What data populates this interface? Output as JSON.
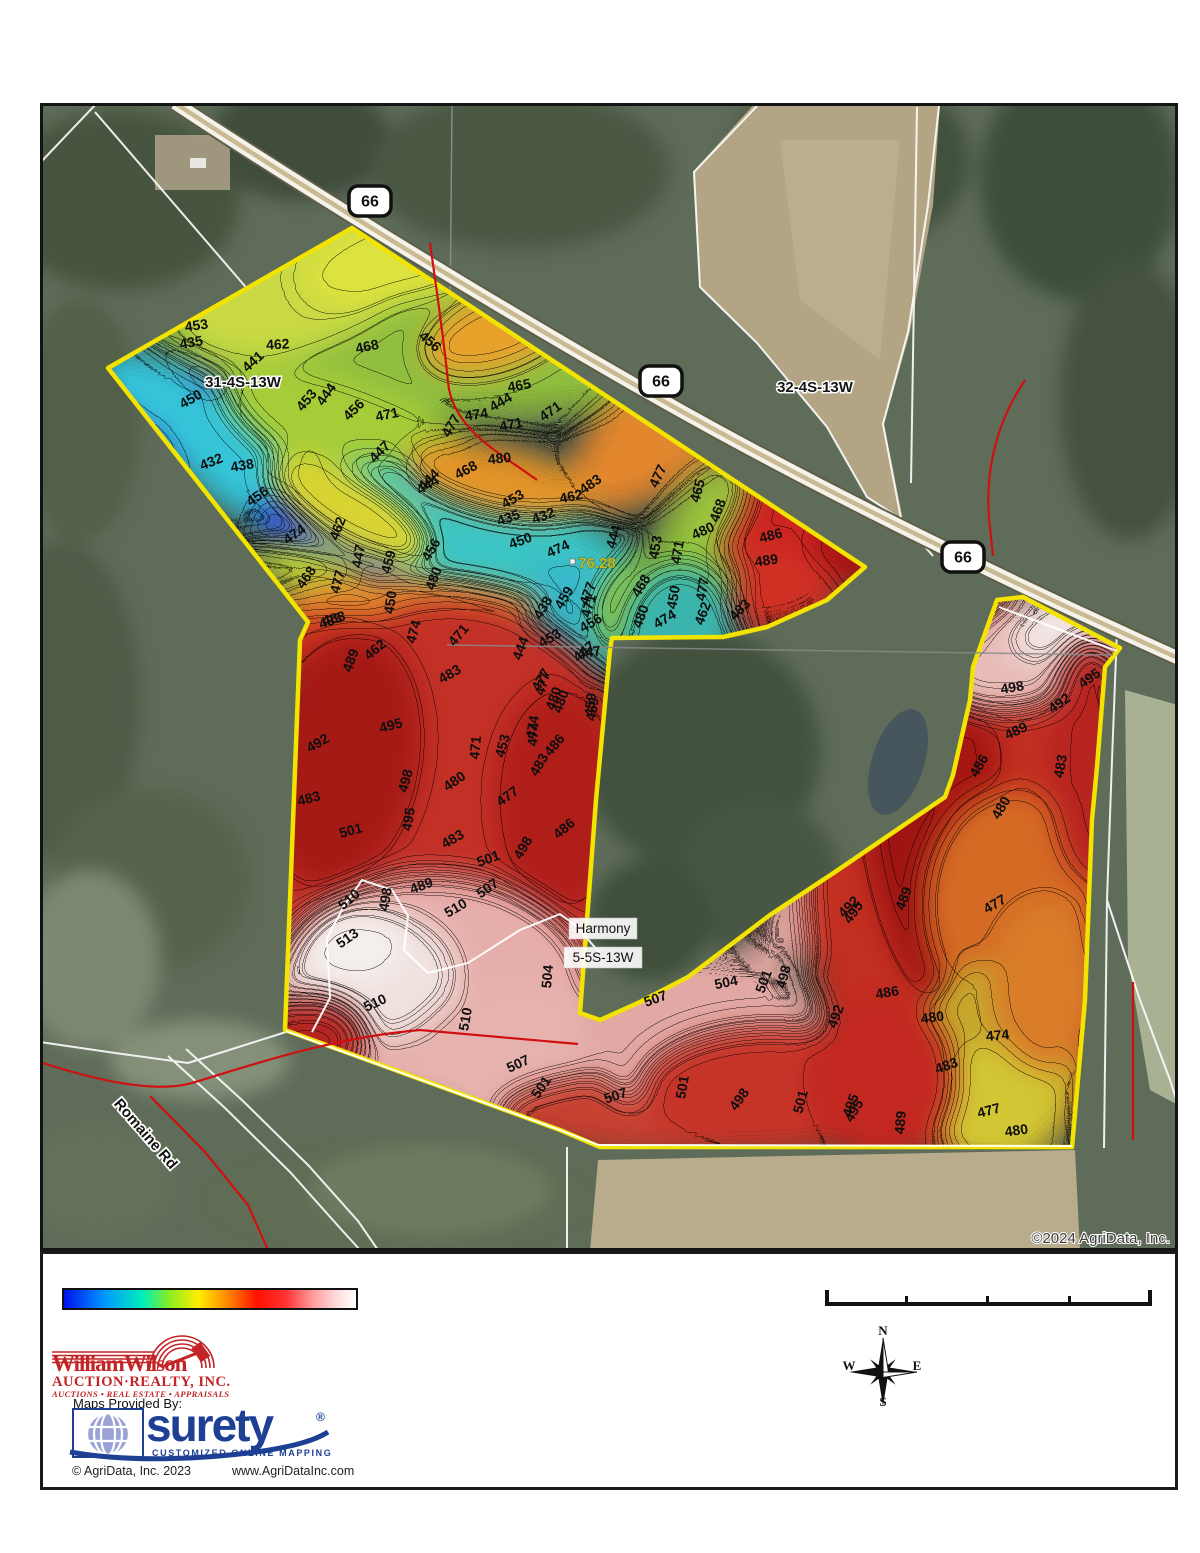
{
  "map": {
    "copyright": "©2024 AgriData, Inc.",
    "parcel_outline_color": "#f2e400",
    "route_shields": [
      {
        "label": "66",
        "x": 370,
        "y": 201
      },
      {
        "label": "66",
        "x": 661,
        "y": 381
      },
      {
        "label": "66",
        "x": 963,
        "y": 557
      }
    ],
    "section_labels": [
      {
        "text": "31-4S-13W",
        "x": 243,
        "y": 387
      },
      {
        "text": "32-4S-13W",
        "x": 815,
        "y": 392
      }
    ],
    "place_labels": [
      {
        "text": "Harmony",
        "x": 603,
        "y": 933,
        "w": 68,
        "h": 21
      },
      {
        "text": "5-5S-13W",
        "x": 603,
        "y": 962,
        "w": 78,
        "h": 21
      }
    ],
    "road_label": {
      "text": "Romaine Rd",
      "x": 142,
      "y": 1137,
      "rot": 49
    },
    "point_label": {
      "text": "76.28",
      "x": 597,
      "y": 568
    },
    "contour_labels": [
      [
        "453",
        197,
        330,
        -8
      ],
      [
        "435",
        192,
        347,
        -10
      ],
      [
        "462",
        278,
        349,
        -3
      ],
      [
        "441",
        256,
        365,
        -42
      ],
      [
        "468",
        368,
        351,
        -12
      ],
      [
        "456",
        427,
        345,
        40
      ],
      [
        "450",
        193,
        403,
        -30
      ],
      [
        "453",
        310,
        403,
        -50
      ],
      [
        "444",
        330,
        397,
        -55
      ],
      [
        "456",
        357,
        413,
        -45
      ],
      [
        "471",
        388,
        419,
        -12
      ],
      [
        "474",
        477,
        419,
        -8
      ],
      [
        "477",
        455,
        428,
        -60
      ],
      [
        "471",
        512,
        429,
        -12
      ],
      [
        "465",
        520,
        390,
        -10
      ],
      [
        "444",
        503,
        406,
        -30
      ],
      [
        "471",
        553,
        415,
        -35
      ],
      [
        "480",
        500,
        463,
        -6
      ],
      [
        "468",
        468,
        474,
        -28
      ],
      [
        "444",
        430,
        489,
        -30
      ],
      [
        "453",
        515,
        503,
        -30
      ],
      [
        "462",
        572,
        501,
        -12
      ],
      [
        "483",
        593,
        488,
        -35
      ],
      [
        "432",
        213,
        466,
        -22
      ],
      [
        "438",
        243,
        470,
        -10
      ],
      [
        "456",
        260,
        500,
        -35
      ],
      [
        "474",
        297,
        538,
        -35
      ],
      [
        "462",
        342,
        530,
        -70
      ],
      [
        "447",
        363,
        557,
        -80
      ],
      [
        "459",
        393,
        563,
        -75
      ],
      [
        "450",
        395,
        603,
        -82
      ],
      [
        "456",
        435,
        552,
        -60
      ],
      [
        "480",
        438,
        580,
        -70
      ],
      [
        "468",
        310,
        580,
        -55
      ],
      [
        "477",
        342,
        583,
        -75
      ],
      [
        "483",
        335,
        623,
        -15
      ],
      [
        "447",
        383,
        455,
        -45
      ],
      [
        "444",
        432,
        483,
        -45
      ],
      [
        "477",
        662,
        478,
        -65
      ],
      [
        "465",
        702,
        492,
        -75
      ],
      [
        "468",
        722,
        512,
        -70
      ],
      [
        "435",
        510,
        522,
        -20
      ],
      [
        "432",
        545,
        520,
        -20
      ],
      [
        "480",
        705,
        535,
        -25
      ],
      [
        "450",
        522,
        545,
        -20
      ],
      [
        "474",
        560,
        553,
        -25
      ],
      [
        "444",
        618,
        538,
        -75
      ],
      [
        "453",
        660,
        548,
        -80
      ],
      [
        "471",
        682,
        553,
        -80
      ],
      [
        "486",
        772,
        540,
        -15
      ],
      [
        "489",
        767,
        565,
        -8
      ],
      [
        "459",
        568,
        600,
        -60
      ],
      [
        "438",
        547,
        610,
        -60
      ],
      [
        "477",
        592,
        595,
        -70
      ],
      [
        "471",
        593,
        607,
        -75
      ],
      [
        "468",
        645,
        588,
        -60
      ],
      [
        "480",
        645,
        618,
        -70
      ],
      [
        "474",
        667,
        623,
        -30
      ],
      [
        "450",
        678,
        598,
        -80
      ],
      [
        "462",
        707,
        615,
        -70
      ],
      [
        "477",
        707,
        590,
        -80
      ],
      [
        "483",
        743,
        613,
        -45
      ],
      [
        "456",
        593,
        627,
        -30
      ],
      [
        "453",
        552,
        642,
        -30
      ],
      [
        "447",
        587,
        655,
        -40
      ],
      [
        "444",
        525,
        650,
        -70
      ],
      [
        "477",
        547,
        685,
        -75
      ],
      [
        "480",
        565,
        703,
        -70
      ],
      [
        "459",
        595,
        705,
        -85
      ],
      [
        "474",
        538,
        735,
        -85
      ],
      [
        "483",
        332,
        625,
        -20
      ],
      [
        "462",
        378,
        653,
        -40
      ],
      [
        "489",
        355,
        662,
        -70
      ],
      [
        "474",
        418,
        633,
        -75
      ],
      [
        "471",
        462,
        638,
        -50
      ],
      [
        "447",
        590,
        657,
        -10
      ],
      [
        "483",
        452,
        678,
        -30
      ],
      [
        "477",
        545,
        682,
        -60
      ],
      [
        "480",
        558,
        700,
        -70
      ],
      [
        "459",
        597,
        710,
        -80
      ],
      [
        "474",
        537,
        728,
        -80
      ],
      [
        "486",
        558,
        748,
        -50
      ],
      [
        "483",
        543,
        767,
        -60
      ],
      [
        "495",
        392,
        730,
        -15
      ],
      [
        "492",
        320,
        747,
        -30
      ],
      [
        "471",
        480,
        748,
        -85
      ],
      [
        "453",
        507,
        747,
        -75
      ],
      [
        "483",
        310,
        803,
        -15
      ],
      [
        "498",
        410,
        782,
        -75
      ],
      [
        "480",
        457,
        785,
        -35
      ],
      [
        "495",
        413,
        820,
        -80
      ],
      [
        "477",
        510,
        800,
        -35
      ],
      [
        "501",
        352,
        835,
        -15
      ],
      [
        "483",
        455,
        843,
        -30
      ],
      [
        "501",
        490,
        863,
        -20
      ],
      [
        "498",
        527,
        850,
        -60
      ],
      [
        "486",
        567,
        832,
        -40
      ],
      [
        "489",
        423,
        890,
        -20
      ],
      [
        "507",
        490,
        892,
        -35
      ],
      [
        "498",
        390,
        900,
        -80
      ],
      [
        "510",
        352,
        903,
        -40
      ],
      [
        "513",
        350,
        942,
        -35
      ],
      [
        "510",
        458,
        912,
        -30
      ],
      [
        "510",
        377,
        1007,
        -25
      ],
      [
        "510",
        470,
        1020,
        -80
      ],
      [
        "504",
        552,
        977,
        -85
      ],
      [
        "507",
        520,
        1068,
        -25
      ],
      [
        "501",
        545,
        1090,
        -55
      ],
      [
        "507",
        617,
        1100,
        -18
      ],
      [
        "507",
        657,
        1003,
        -20
      ],
      [
        "504",
        727,
        987,
        -12
      ],
      [
        "501",
        768,
        983,
        -70
      ],
      [
        "498",
        788,
        978,
        -75
      ],
      [
        "495",
        857,
        915,
        -55
      ],
      [
        "492",
        840,
        1018,
        -70
      ],
      [
        "501",
        687,
        1088,
        -80
      ],
      [
        "498",
        743,
        1102,
        -55
      ],
      [
        "501",
        805,
        1103,
        -75
      ],
      [
        "495",
        855,
        1107,
        -70
      ],
      [
        "498",
        1013,
        692,
        -10
      ],
      [
        "492",
        1062,
        707,
        -35
      ],
      [
        "495",
        1092,
        682,
        -35
      ],
      [
        "489",
        1018,
        735,
        -25
      ],
      [
        "486",
        983,
        768,
        -60
      ],
      [
        "483",
        1065,
        767,
        -80
      ],
      [
        "480",
        1005,
        810,
        -60
      ],
      [
        "477",
        997,
        908,
        -30
      ],
      [
        "489",
        908,
        900,
        -70
      ],
      [
        "492",
        852,
        910,
        -45
      ],
      [
        "486",
        888,
        997,
        -10
      ],
      [
        "480",
        933,
        1022,
        -8
      ],
      [
        "474",
        998,
        1040,
        -5
      ],
      [
        "483",
        948,
        1070,
        -20
      ],
      [
        "495",
        858,
        1113,
        -60
      ],
      [
        "489",
        905,
        1123,
        -85
      ],
      [
        "477",
        990,
        1115,
        -15
      ],
      [
        "480",
        1017,
        1135,
        -8
      ]
    ]
  },
  "legend": {
    "stops": [
      {
        "c": "#0011ee",
        "p": 0
      },
      {
        "c": "#0099ff",
        "p": 14
      },
      {
        "c": "#00eebb",
        "p": 27
      },
      {
        "c": "#88ee22",
        "p": 36
      },
      {
        "c": "#ffee00",
        "p": 46
      },
      {
        "c": "#ff8800",
        "p": 56
      },
      {
        "c": "#ff1100",
        "p": 66
      },
      {
        "c": "#ff3333",
        "p": 76
      },
      {
        "c": "#ff9999",
        "p": 85
      },
      {
        "c": "#ffd9d9",
        "p": 93
      },
      {
        "c": "#ffffff",
        "p": 100
      }
    ]
  },
  "footer": {
    "william_wilson": {
      "line1": "WilliamWilson",
      "line2": "AUCTION·REALTY, INC.",
      "line3": "AUCTIONS • REAL ESTATE • APPRAISALS"
    },
    "maps_provided": "Maps Provided By:",
    "surety": {
      "name": "surety",
      "reg": "®",
      "tagline": "CUSTOMIZED ONLINE MAPPING"
    },
    "agridata_copyright": "© AgriData, Inc. 2023",
    "agridata_url": "www.AgriDataInc.com",
    "compass": {
      "n": "N",
      "e": "E",
      "s": "S",
      "w": "W"
    }
  }
}
